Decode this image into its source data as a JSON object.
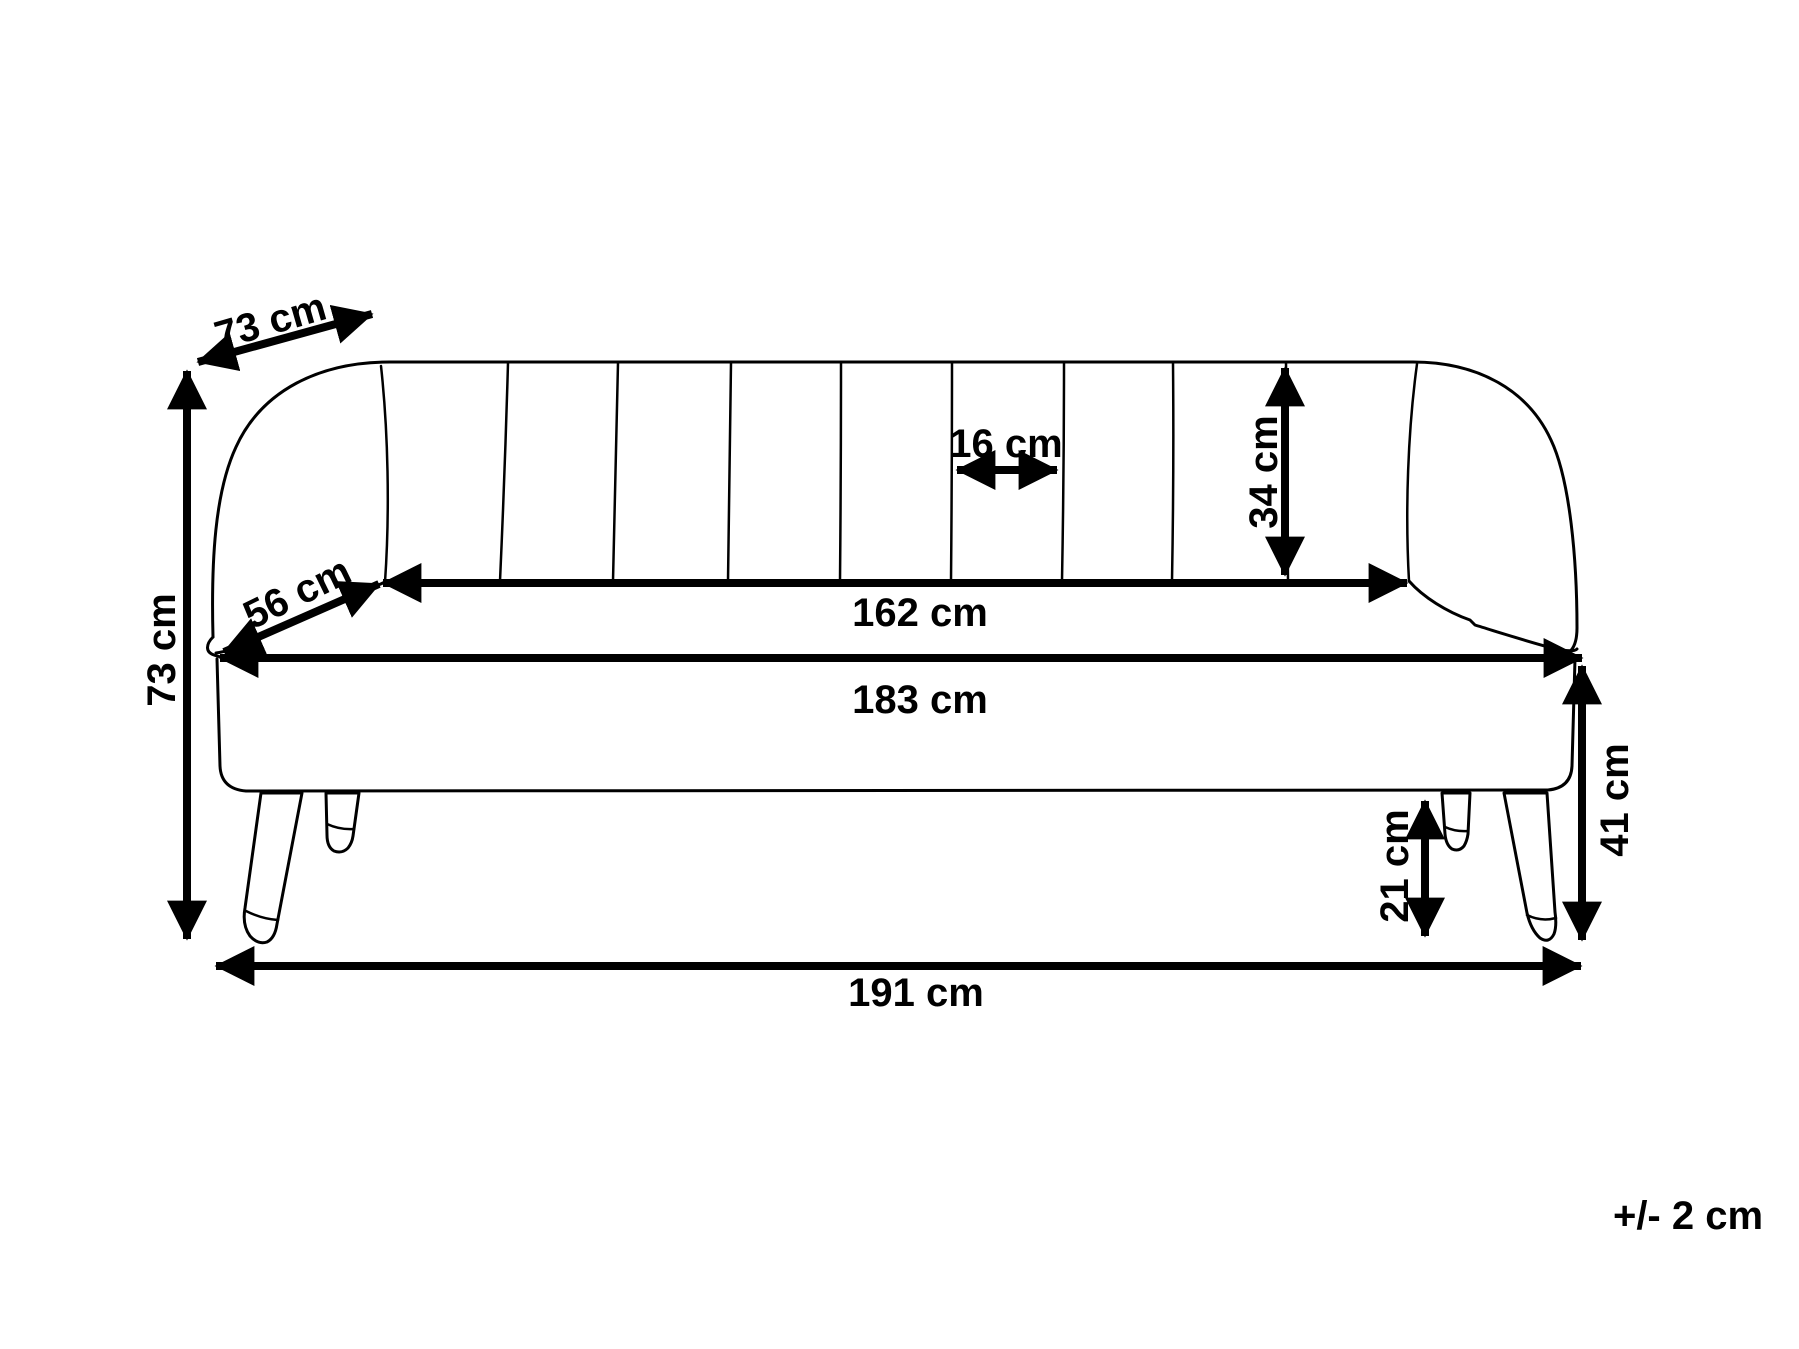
{
  "diagram": {
    "unit": "cm",
    "colors": {
      "line": "#000000",
      "background": "#ffffff"
    },
    "tolerance": {
      "label": "+/- 2 cm"
    },
    "dimensions": {
      "depth_overall": {
        "label": "73 cm",
        "value": 73
      },
      "height_overall": {
        "label": "73 cm",
        "value": 73
      },
      "seat_depth": {
        "label": "56 cm",
        "value": 56
      },
      "channel_width": {
        "label": "16 cm",
        "value": 16
      },
      "backrest_height": {
        "label": "34 cm",
        "value": 34
      },
      "seat_width": {
        "label": "162 cm",
        "value": 162
      },
      "body_width": {
        "label": "183 cm",
        "value": 183
      },
      "base_height": {
        "label": "41 cm",
        "value": 41
      },
      "leg_height": {
        "label": "21 cm",
        "value": 21
      },
      "width_overall": {
        "label": "191 cm",
        "value": 191
      }
    }
  }
}
